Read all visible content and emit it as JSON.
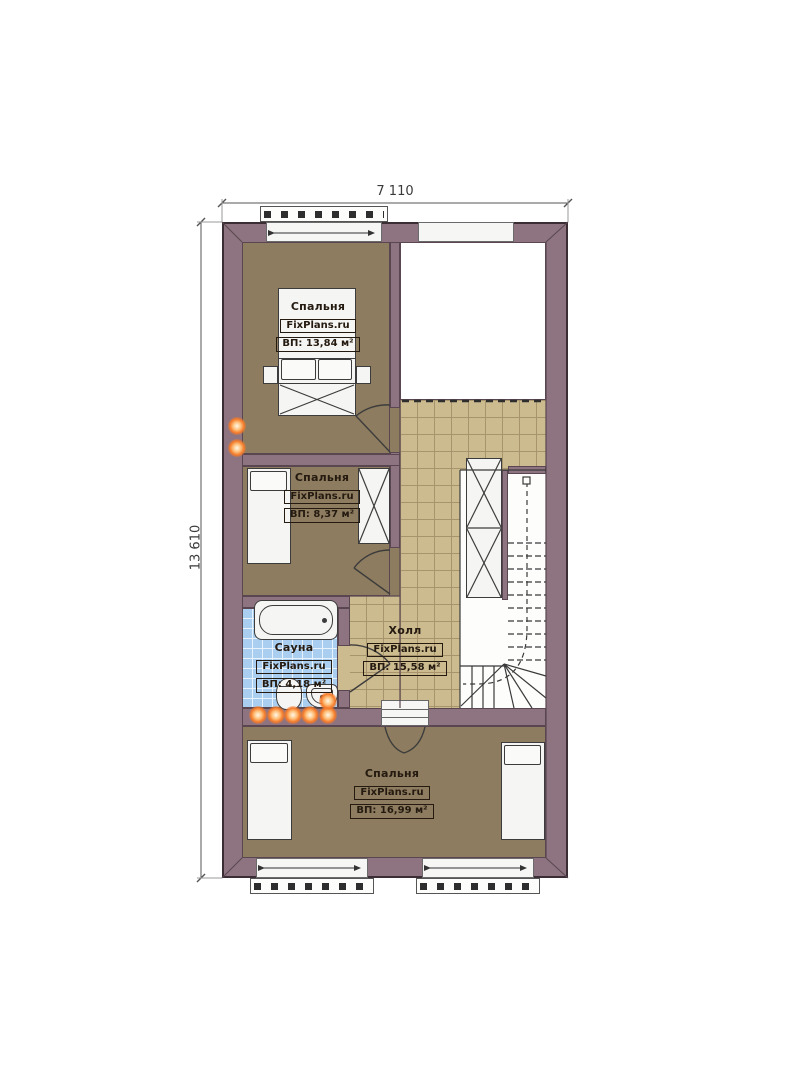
{
  "dimensions": {
    "width_label": "7 110",
    "height_label": "13 610"
  },
  "brand": "FixPlans.ru",
  "rooms": {
    "bedroom_top": {
      "name": "Спальня",
      "brand": "FixPlans.ru",
      "area": "ВП: 13,84 м²"
    },
    "bedroom_middle": {
      "name": "Спальня",
      "brand": "FixPlans.ru",
      "area": "ВП: 8,37 м²"
    },
    "sauna": {
      "name": "Сауна",
      "brand": "FixPlans.ru",
      "area": "ВП: 4,18 м²"
    },
    "hall": {
      "name": "Холл",
      "brand": "FixPlans.ru",
      "area": "ВП: 15,58 м²"
    },
    "bedroom_bottom": {
      "name": "Спальня",
      "brand": "FixPlans.ru",
      "area": "ВП: 16,99 м²"
    }
  },
  "colors": {
    "wall": "#8d7480",
    "wood_floor": "#8d7c5f",
    "hall_tile": "#cdbb90",
    "sauna_tile": "#aaceef",
    "lamp_accent": "#f47a2a",
    "outline": "#3b2d34"
  }
}
